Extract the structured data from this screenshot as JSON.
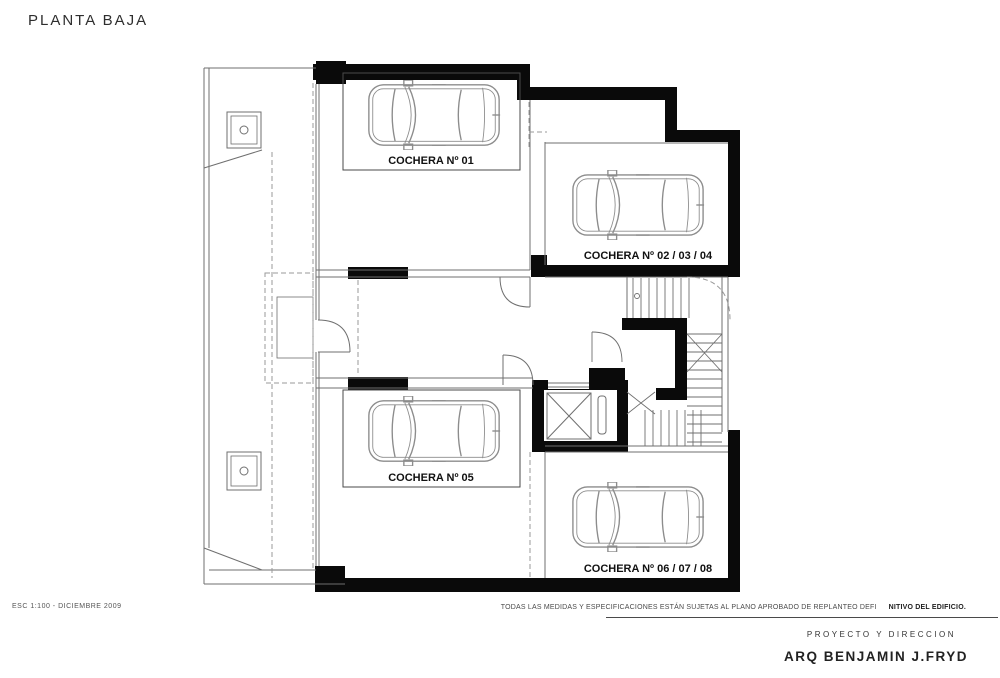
{
  "title": "PLANTA BAJA",
  "plan": {
    "garage_labels": [
      {
        "id": "cochera-01",
        "text": "COCHERA Nº 01"
      },
      {
        "id": "cochera-02-03-04",
        "text": "COCHERA Nº 02 / 03 / 04"
      },
      {
        "id": "cochera-05",
        "text": "COCHERA Nº 05"
      },
      {
        "id": "cochera-06-07-08",
        "text": "COCHERA Nº 06 / 07 / 08"
      }
    ]
  },
  "footer": {
    "scale_note": "ESC 1:100 - DICIEMBRE 2009",
    "disclaimer_regular": "TODAS LAS MEDIDAS Y ESPECIFICACIONES ESTÁN SUJETAS AL PLANO APROBADO DE REPLANTEO DEFI",
    "disclaimer_bold": "NITIVO DEL EDIFICIO.",
    "project_label": "PROYECTO Y DIRECCION",
    "architect": "ARQ BENJAMIN J.FRYD"
  },
  "colors": {
    "wall": "#0a0a0a",
    "thin_line": "#6f6f6f",
    "dashed_line": "#9a9a9a",
    "car_line": "#8c8c8c"
  }
}
